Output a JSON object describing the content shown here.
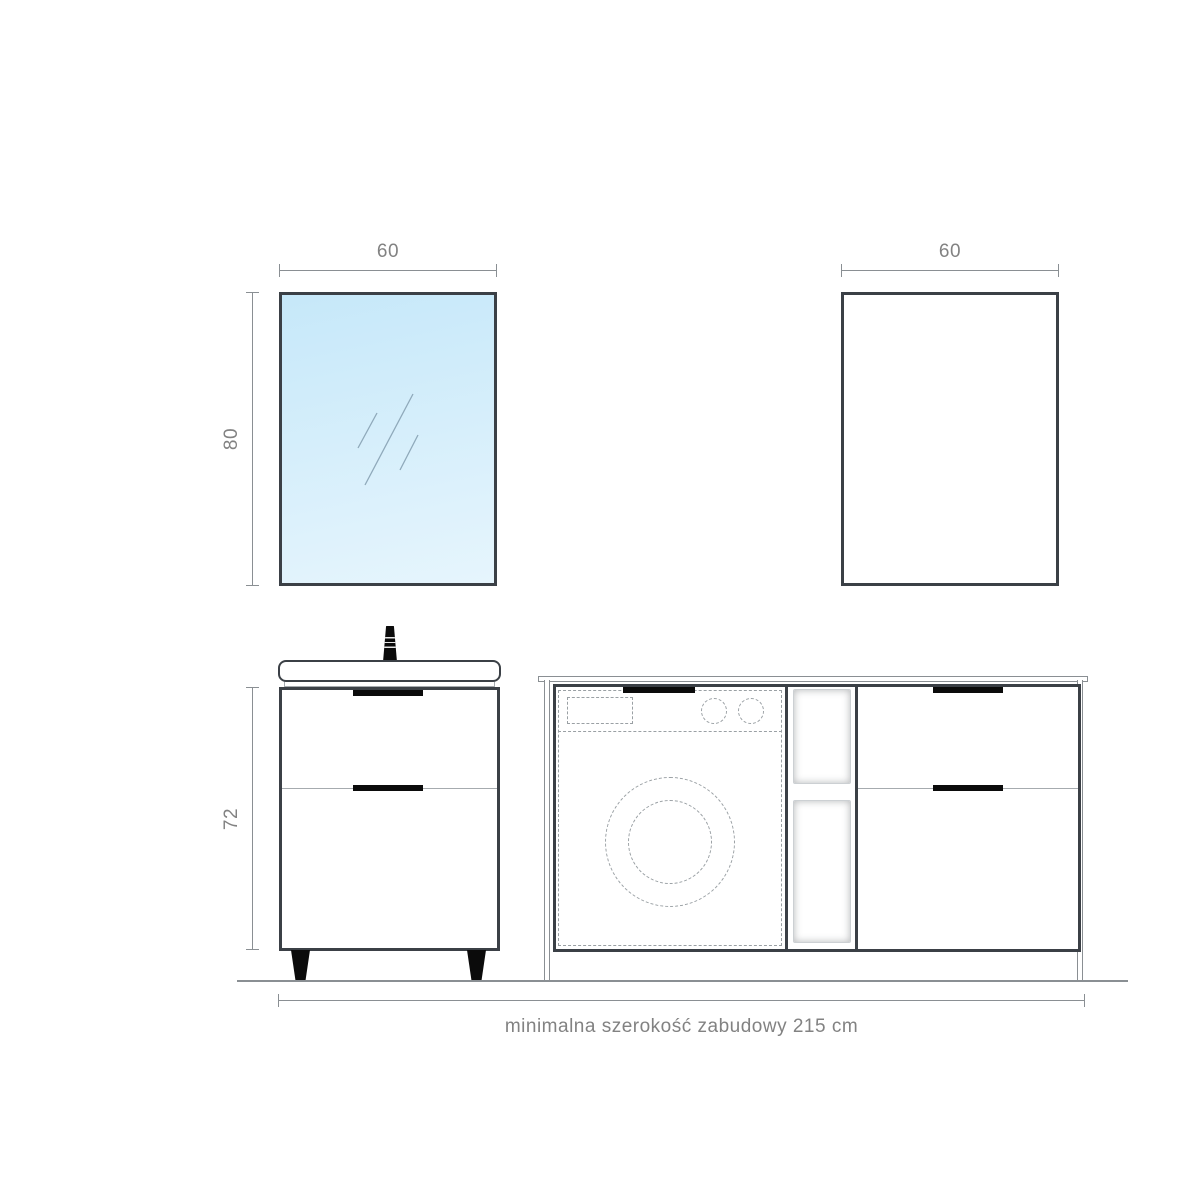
{
  "drawing": {
    "labels": {
      "mirror_width": "60",
      "mirror_height": "80",
      "wall_cabinet_width": "60",
      "vanity_height": "72",
      "total_width_note": "minimalna szerokość zabudowy 215 cm"
    },
    "colors": {
      "outline": "#3b4046",
      "accent_black": "#0b0b0b",
      "dimension_gray": "#8a8f93",
      "text_gray": "#828282",
      "dashed_gray": "#9aa0a4",
      "thin_gray": "#a6abaf",
      "mirror_blue_top": "#c6e8f9",
      "mirror_blue_bottom": "#e6f5fd",
      "background": "#ffffff"
    },
    "elements": [
      "mirror",
      "wall-cabinet",
      "washbasin-vanity",
      "washing-machine-enclosure",
      "open-shelves",
      "drawer-unit",
      "floor-line"
    ]
  }
}
